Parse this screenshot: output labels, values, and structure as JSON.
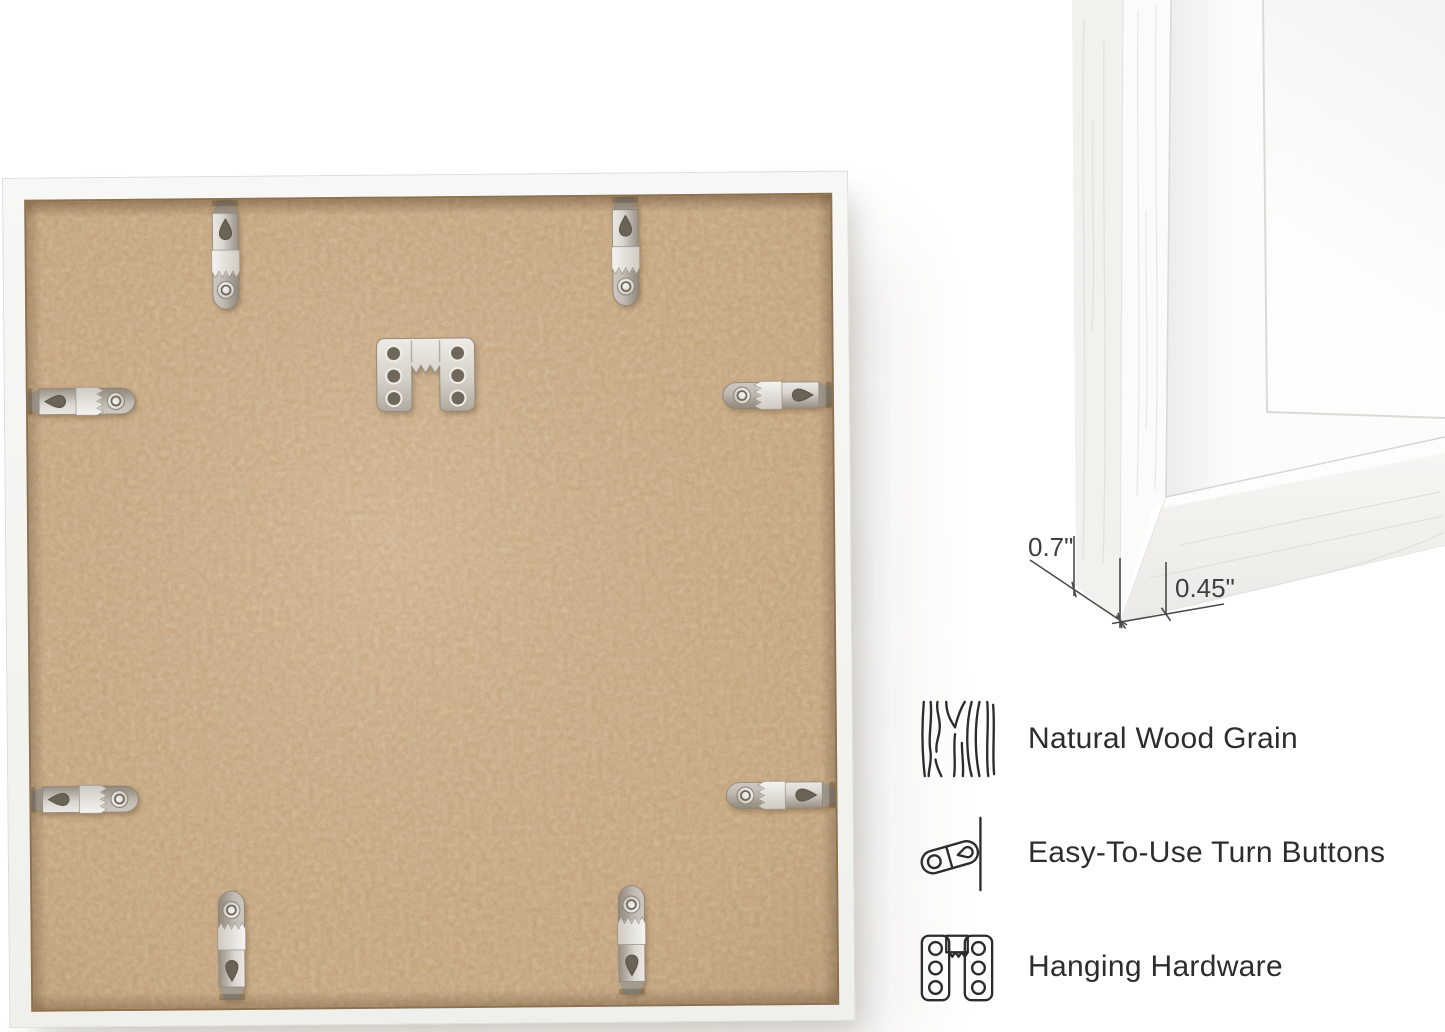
{
  "product_photo": {
    "description_label": "frame-back-with-hardware",
    "board_color": "#cbaa82",
    "frame_color": "#f5f5f3",
    "metal_light": "#ece9e4",
    "metal_dark": "#9a9186",
    "turn_button_count": 8
  },
  "detail_photo": {
    "dimensions": {
      "depth_label": "0.7\"",
      "face_label": "0.45\""
    }
  },
  "features": {
    "items": [
      {
        "icon": "wood-grain-icon",
        "label": "Natural Wood Grain"
      },
      {
        "icon": "turn-button-icon",
        "label": "Easy-To-Use Turn Buttons"
      },
      {
        "icon": "hanging-hardware-icon",
        "label": "Hanging Hardware"
      }
    ]
  },
  "colors": {
    "background": "#ffffff",
    "text": "#2d2d2d",
    "dimension_lines": "#4b4b4b",
    "mat_white": "#fcfcfb",
    "shadow": "rgba(88,72,50,0.22)"
  }
}
